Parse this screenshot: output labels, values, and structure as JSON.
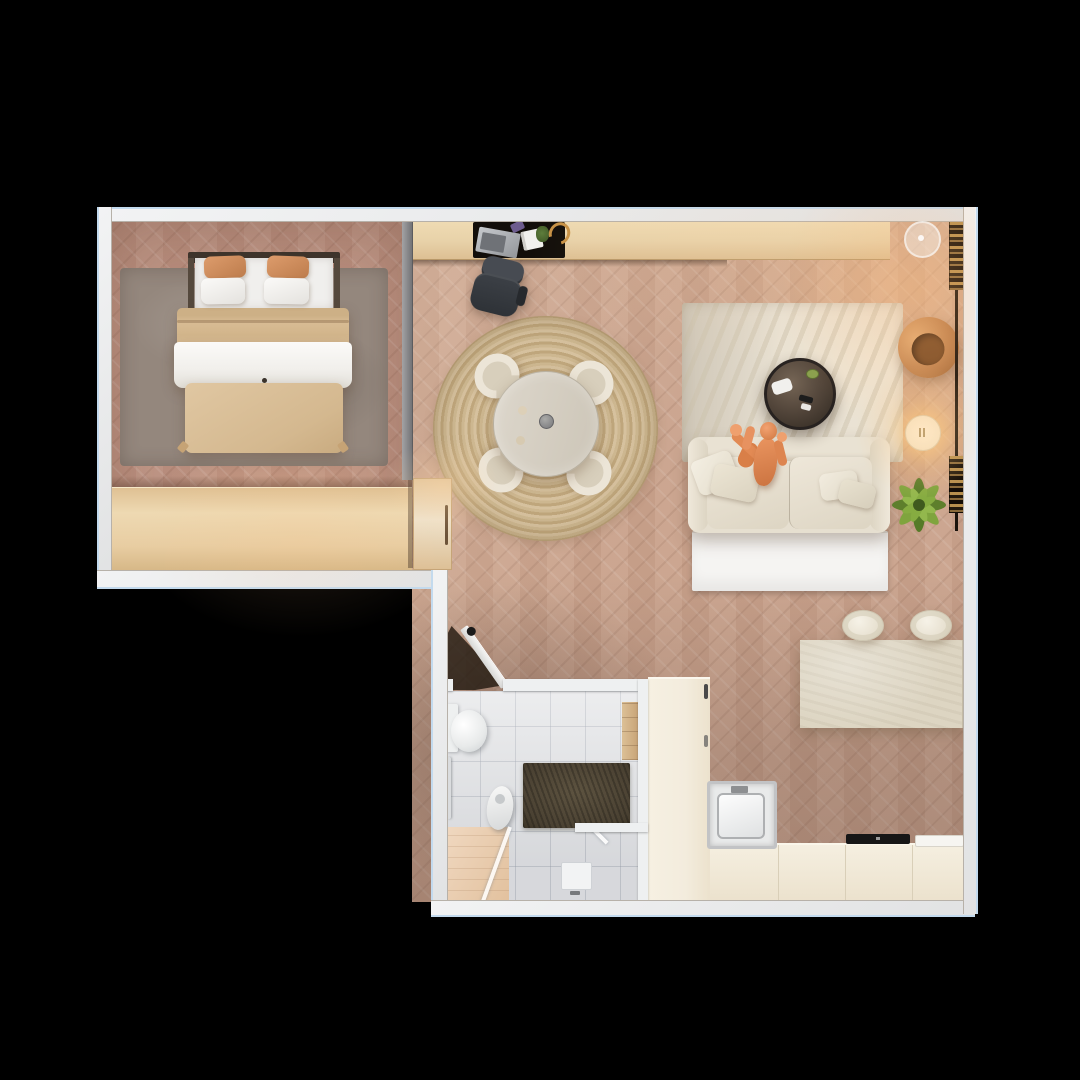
{
  "scene": {
    "description": "Top-down 3D render of a studio apartment floor plan on a black background",
    "background_color": "#000000",
    "canvas": {
      "width": 1080,
      "height": 1080
    },
    "view": "top-down orthographic",
    "visible_text": ""
  },
  "palette": {
    "scene_bg": "#000000",
    "wall": "#eef0f1",
    "wall_outer_tint": "#c3daee",
    "bedroom_floor": "#bb9080",
    "living_floor": "#c9a28c",
    "tile_floor": "#e4e5e7",
    "wood_console": "#e8d2a9",
    "cabinet_cream": "#f3ecdd",
    "island_stone": "#ddd5c2",
    "sofa_cream": "#e6dfd0",
    "rug_living": "#e8e1d3",
    "rug_bedroom": "#94877d",
    "rug_jute": "#c9b290",
    "person_orange": "#e08c58",
    "plant_green": "#6f9637",
    "armchair_tan": "#c08350",
    "desk_dark": "#120e0a",
    "dark_mat": "#4a4132",
    "warm_glow": "#ffba73"
  },
  "rooms": {
    "bedroom": {
      "name": "bedroom",
      "furniture": [
        "double-bed",
        "orange-pillows",
        "white-pillows",
        "beige-duvet",
        "gray-area-rug",
        "wardrobe",
        "open-wood-door"
      ]
    },
    "living_room": {
      "name": "living-room",
      "furniture": [
        "wall-desk-console",
        "laptop",
        "notebook",
        "desk-lamp",
        "office-chair",
        "round-jute-rug",
        "round-dining-table",
        "four-dining-chairs",
        "ivory-rug",
        "round-glass-coffee-table",
        "game-controller",
        "sofa",
        "tv-bench",
        "swivel-armchair",
        "glowing-floor-lamp",
        "potted-plant",
        "wall-book-rail",
        "ceiling-light"
      ]
    },
    "kitchen": {
      "name": "kitchen",
      "furniture": [
        "tall-cabinet-column",
        "built-in-appliance",
        "base-counter",
        "black-cooktop",
        "cutting-board",
        "stone-island",
        "two-bar-stools"
      ]
    },
    "bathroom": {
      "name": "bathroom",
      "furniture": [
        "toilet",
        "pedestal-sink",
        "towel-rail",
        "dark-stone-mat",
        "wood-shelf",
        "shower-drain",
        "glass-screen",
        "wood-bath-mat",
        "open-door"
      ]
    }
  },
  "occupant": {
    "name": "person-on-sofa",
    "pose": "sitting on sofa with arms raised toward coffee table"
  }
}
